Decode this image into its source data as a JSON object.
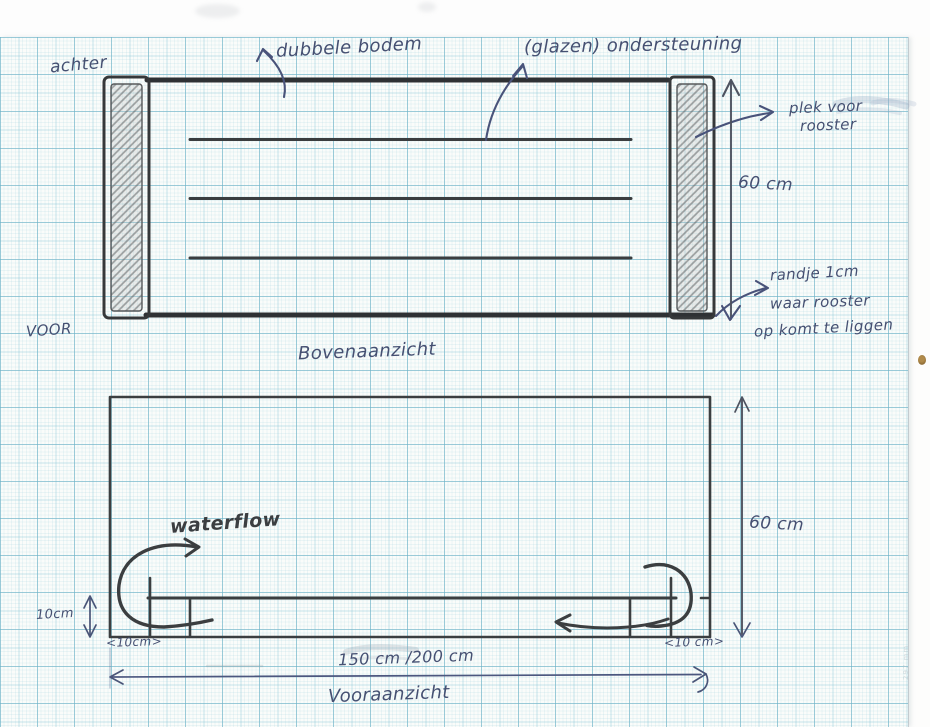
{
  "sketch": {
    "top_view": {
      "caption": "Bovenaanzicht",
      "label_back": "achter",
      "label_front": "VOOR",
      "annotation_double_bottom": "dubbele bodem",
      "annotation_glass_support": "(glazen) ondersteuning",
      "annotation_grate_spot_line1": "plek voor",
      "annotation_grate_spot_line2": "rooster",
      "dimension_depth": "60 cm",
      "annotation_rim_line1": "randje 1cm",
      "annotation_rim_line2": "waar rooster",
      "annotation_rim_line3": "op komt te liggen"
    },
    "front_view": {
      "caption": "Vooraanzicht",
      "annotation_waterflow": "waterflow",
      "dimension_height": "60 cm",
      "dimension_floor_height": "10cm",
      "dimension_left_width": "<10cm>",
      "dimension_right_width": "<10 cm>",
      "dimension_length": "150 cm /200 cm"
    },
    "paper_margin_note": "297 mm"
  }
}
